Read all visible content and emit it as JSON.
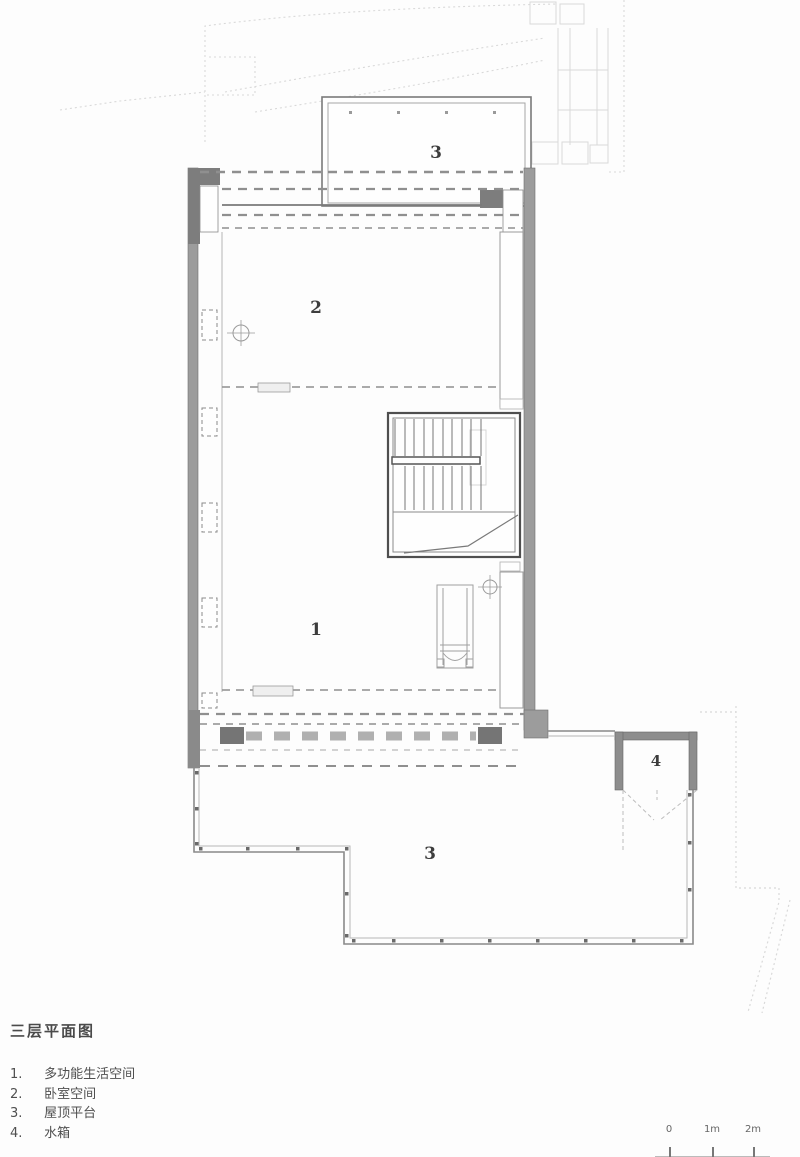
{
  "page": {
    "title": "三层平面图"
  },
  "legend": {
    "items": [
      {
        "num": "1.",
        "label": "多功能生活空间"
      },
      {
        "num": "2.",
        "label": "卧室空间"
      },
      {
        "num": "3.",
        "label": "屋顶平台"
      },
      {
        "num": "4.",
        "label": "水箱"
      }
    ]
  },
  "plan": {
    "labels": {
      "room1": "1",
      "room2": "2",
      "roof_upper": "3",
      "roof_lower": "3",
      "tank": "4"
    }
  },
  "scale_bar": {
    "labels": [
      "0",
      "1m",
      "2m"
    ]
  },
  "colors": {
    "wall_gray": "#9c9c9c",
    "dark_gray": "#757575",
    "line_gray": "#5f5f5f",
    "faint_gray": "#d9d9d9",
    "text_gray": "#4f4f4f"
  }
}
